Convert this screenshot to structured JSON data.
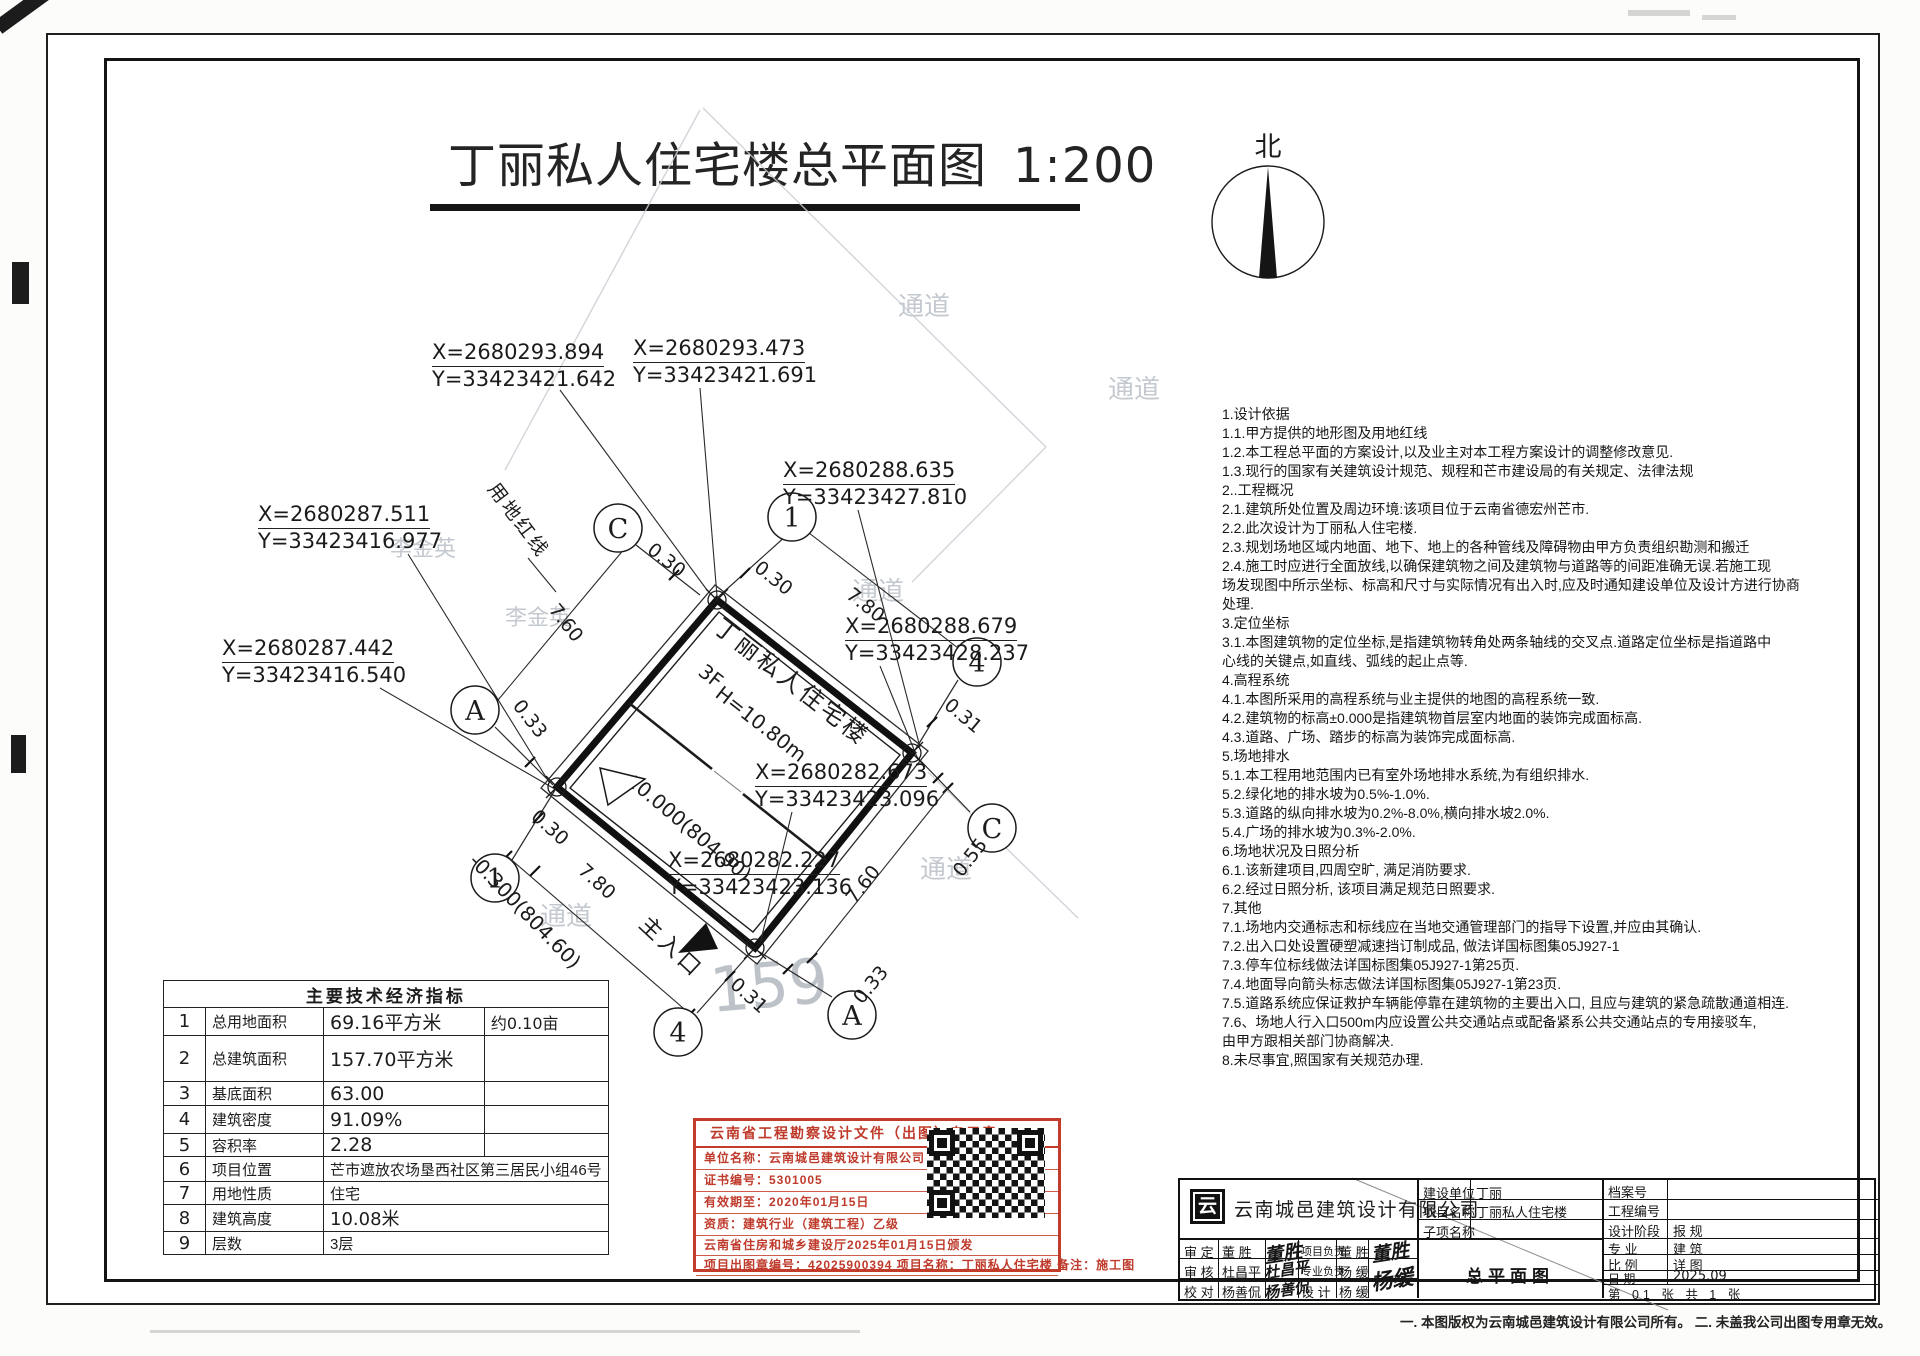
{
  "sheet": {
    "title": "丁丽私人住宅楼总平面图",
    "scale": "1:200",
    "north_label": "北",
    "footnote": "一. 本图版权为云南城邑建筑设计有限公司所有。 二. 未盖我公司出图专用章无效。"
  },
  "plan": {
    "building_name": "丁丽私人住宅楼",
    "floors": "3F",
    "height": "H=10.80m",
    "level_main": "±0.000(804.90)",
    "level_entrance": "-0.300(804.60)",
    "entrance": "主入口",
    "red_line": "用地红线",
    "ghost_number": "159",
    "ghost_labels": [
      "通道",
      "通道",
      "通道",
      "通道",
      "通道",
      "李金英",
      "李金英"
    ],
    "axes": [
      "C",
      "1",
      "A",
      "1",
      "4",
      "C",
      "4",
      "A"
    ],
    "dims": [
      "0.30",
      "7.60",
      "0.30",
      "7.80",
      "0.31",
      "0.33",
      "0.30",
      "7.80",
      "0.31",
      "0.33",
      "7.60",
      "0.55"
    ],
    "coords": [
      {
        "x": "X=2680293.894",
        "y": "Y=33423421.642"
      },
      {
        "x": "X=2680293.473",
        "y": "Y=33423421.691"
      },
      {
        "x": "X=2680288.635",
        "y": "Y=33423427.810"
      },
      {
        "x": "X=2680287.511",
        "y": "Y=33423416.977"
      },
      {
        "x": "X=2680287.442",
        "y": "Y=33423416.540"
      },
      {
        "x": "X=2680288.679",
        "y": "Y=33423428.237"
      },
      {
        "x": "X=2680282.673",
        "y": "Y=33423423.096"
      },
      {
        "x": "X=2680282.227",
        "y": "Y=33423423.136"
      }
    ]
  },
  "notes": [
    "1.设计依据",
    "1.1.甲方提供的地形图及用地红线",
    "1.2.本工程总平面的方案设计,以及业主对本工程方案设计的调整修改意见.",
    "1.3.现行的国家有关建筑设计规范、规程和芒市建设局的有关规定、法律法规",
    "2..工程概况",
    "2.1.建筑所处位置及周边环境:该项目位于云南省德宏州芒市.",
    "2.2.此次设计为丁丽私人住宅楼.",
    "2.3.规划场地区域内地面、地下、地上的各种管线及障碍物由甲方负责组织勘测和搬迁",
    "2.4.施工时应进行全面放线,以确保建筑物之间及建筑物与道路等的间距准确无误.若施工现",
    "场发现图中所示坐标、标高和尺寸与实际情况有出入时,应及时通知建设单位及设计方进行协商",
    "处理.",
    "3.定位坐标",
    "3.1.本图建筑物的定位坐标,是指建筑物转角处两条轴线的交叉点.道路定位坐标是指道路中",
    "心线的关键点,如直线、弧线的起止点等.",
    "4.高程系统",
    "4.1.本图所采用的高程系统与业主提供的地图的高程系统一致.",
    "4.2.建筑物的标高±0.000是指建筑物首层室内地面的装饰完成面标高.",
    "4.3.道路、广场、踏步的标高为装饰完成面标高.",
    "5.场地排水",
    "5.1.本工程用地范围内已有室外场地排水系统,为有组织排水.",
    "5.2.绿化地的排水坡为0.5%-1.0%.",
    "5.3.道路的纵向排水坡为0.2%-8.0%,横向排水坡2.0%.",
    "5.4.广场的排水坡为0.3%-2.0%.",
    "6.场地状况及日照分析",
    "6.1.该新建项目,四周空旷, 满足消防要求.",
    "6.2.经过日照分析, 该项目满足规范日照要求.",
    "7.其他",
    "7.1.场地内交通标志和标线应在当地交通管理部门的指导下设置,并应由其确认.",
    "7.2.出入口处设置硬塑减速挡订制成品, 做法详国标图集05J927-1",
    "7.3.停车位标线做法详国标图集05J927-1第25页.",
    "7.4.地面导向箭头标志做法详国标图集05J927-1第23页.",
    "7.5.道路系统应保证救护车辆能停靠在建筑物的主要出入口, 且应与建筑的紧急疏散通道相连.",
    "7.6、场地人行入口500m内应设置公共交通站点或配备紧系公共交通站点的专用接驳车,",
    "由甲方跟相关部门协商解决.",
    "8.未尽事宜,照国家有关规范办理."
  ],
  "table": {
    "title": "主要技术经济指标",
    "rows": [
      {
        "no": "1",
        "label": "总用地面积",
        "value": "69.16平方米",
        "extra": "约0.10亩"
      },
      {
        "no": "2",
        "label": "总建筑面积",
        "value": "157.70平方米",
        "extra": ""
      },
      {
        "no": "3",
        "label": "基底面积",
        "value": "63.00",
        "extra": ""
      },
      {
        "no": "4",
        "label": "建筑密度",
        "value": "91.09%",
        "extra": ""
      },
      {
        "no": "5",
        "label": "容积率",
        "value": "2.28",
        "extra": ""
      },
      {
        "no": "6",
        "label": "项目位置",
        "value": "芒市遮放农场垦西社区第三居民小组46号"
      },
      {
        "no": "7",
        "label": "用地性质",
        "value": "住宅"
      },
      {
        "no": "8",
        "label": "建筑高度",
        "value": "10.08米"
      },
      {
        "no": "9",
        "label": "层数",
        "value": "3层"
      }
    ]
  },
  "stamp": {
    "header": "云南省工程勘察设计文件（出图）专用章",
    "lines": [
      "单位名称：云南城邑建筑设计有限公司",
      "证书编号：5301005",
      "有效期至：2020年01月15日",
      "资质：建筑行业（建筑工程）乙级",
      "云南省住房和城乡建设厅2025年01月15日颁发",
      "项目出图章编号：42025900394  项目名称：丁丽私人住宅楼  备注：施工图"
    ]
  },
  "titleblock": {
    "logo_char": "云",
    "company": "云南城邑建筑设计有限公司",
    "client_label": "建设单位",
    "client": "丁丽",
    "project_label": "项目名称",
    "project": "丁丽私人住宅楼",
    "subproject_label": "子项名称",
    "subproject": "",
    "archive_label": "档案号",
    "archive": "",
    "job_label": "工程编号",
    "job": "",
    "stage_label": "设计阶段",
    "stage": "报 规",
    "discipline_label": "专 业",
    "discipline": "建 筑",
    "scale_label": "比 例",
    "scale": "详 图",
    "date_label": "日 期",
    "date": "2025.09",
    "sheet_info": "第 01 张 共 1 张",
    "drawing_title": "总平面图",
    "roles": [
      {
        "label": "审 定",
        "name": "董 胜",
        "sig": "董胜",
        "label2": "项目负责",
        "name2": "董 胜",
        "sig2": "董胜"
      },
      {
        "label": "审 核",
        "name": "杜昌平",
        "sig": "杜昌平",
        "label2": "专业负责",
        "name2": "杨 缓",
        "sig2": "杨缓"
      },
      {
        "label": "校 对",
        "name": "杨善侃",
        "sig": "杨善侃",
        "label2": "设 计",
        "name2": "杨 缓",
        "sig2": ""
      }
    ]
  }
}
